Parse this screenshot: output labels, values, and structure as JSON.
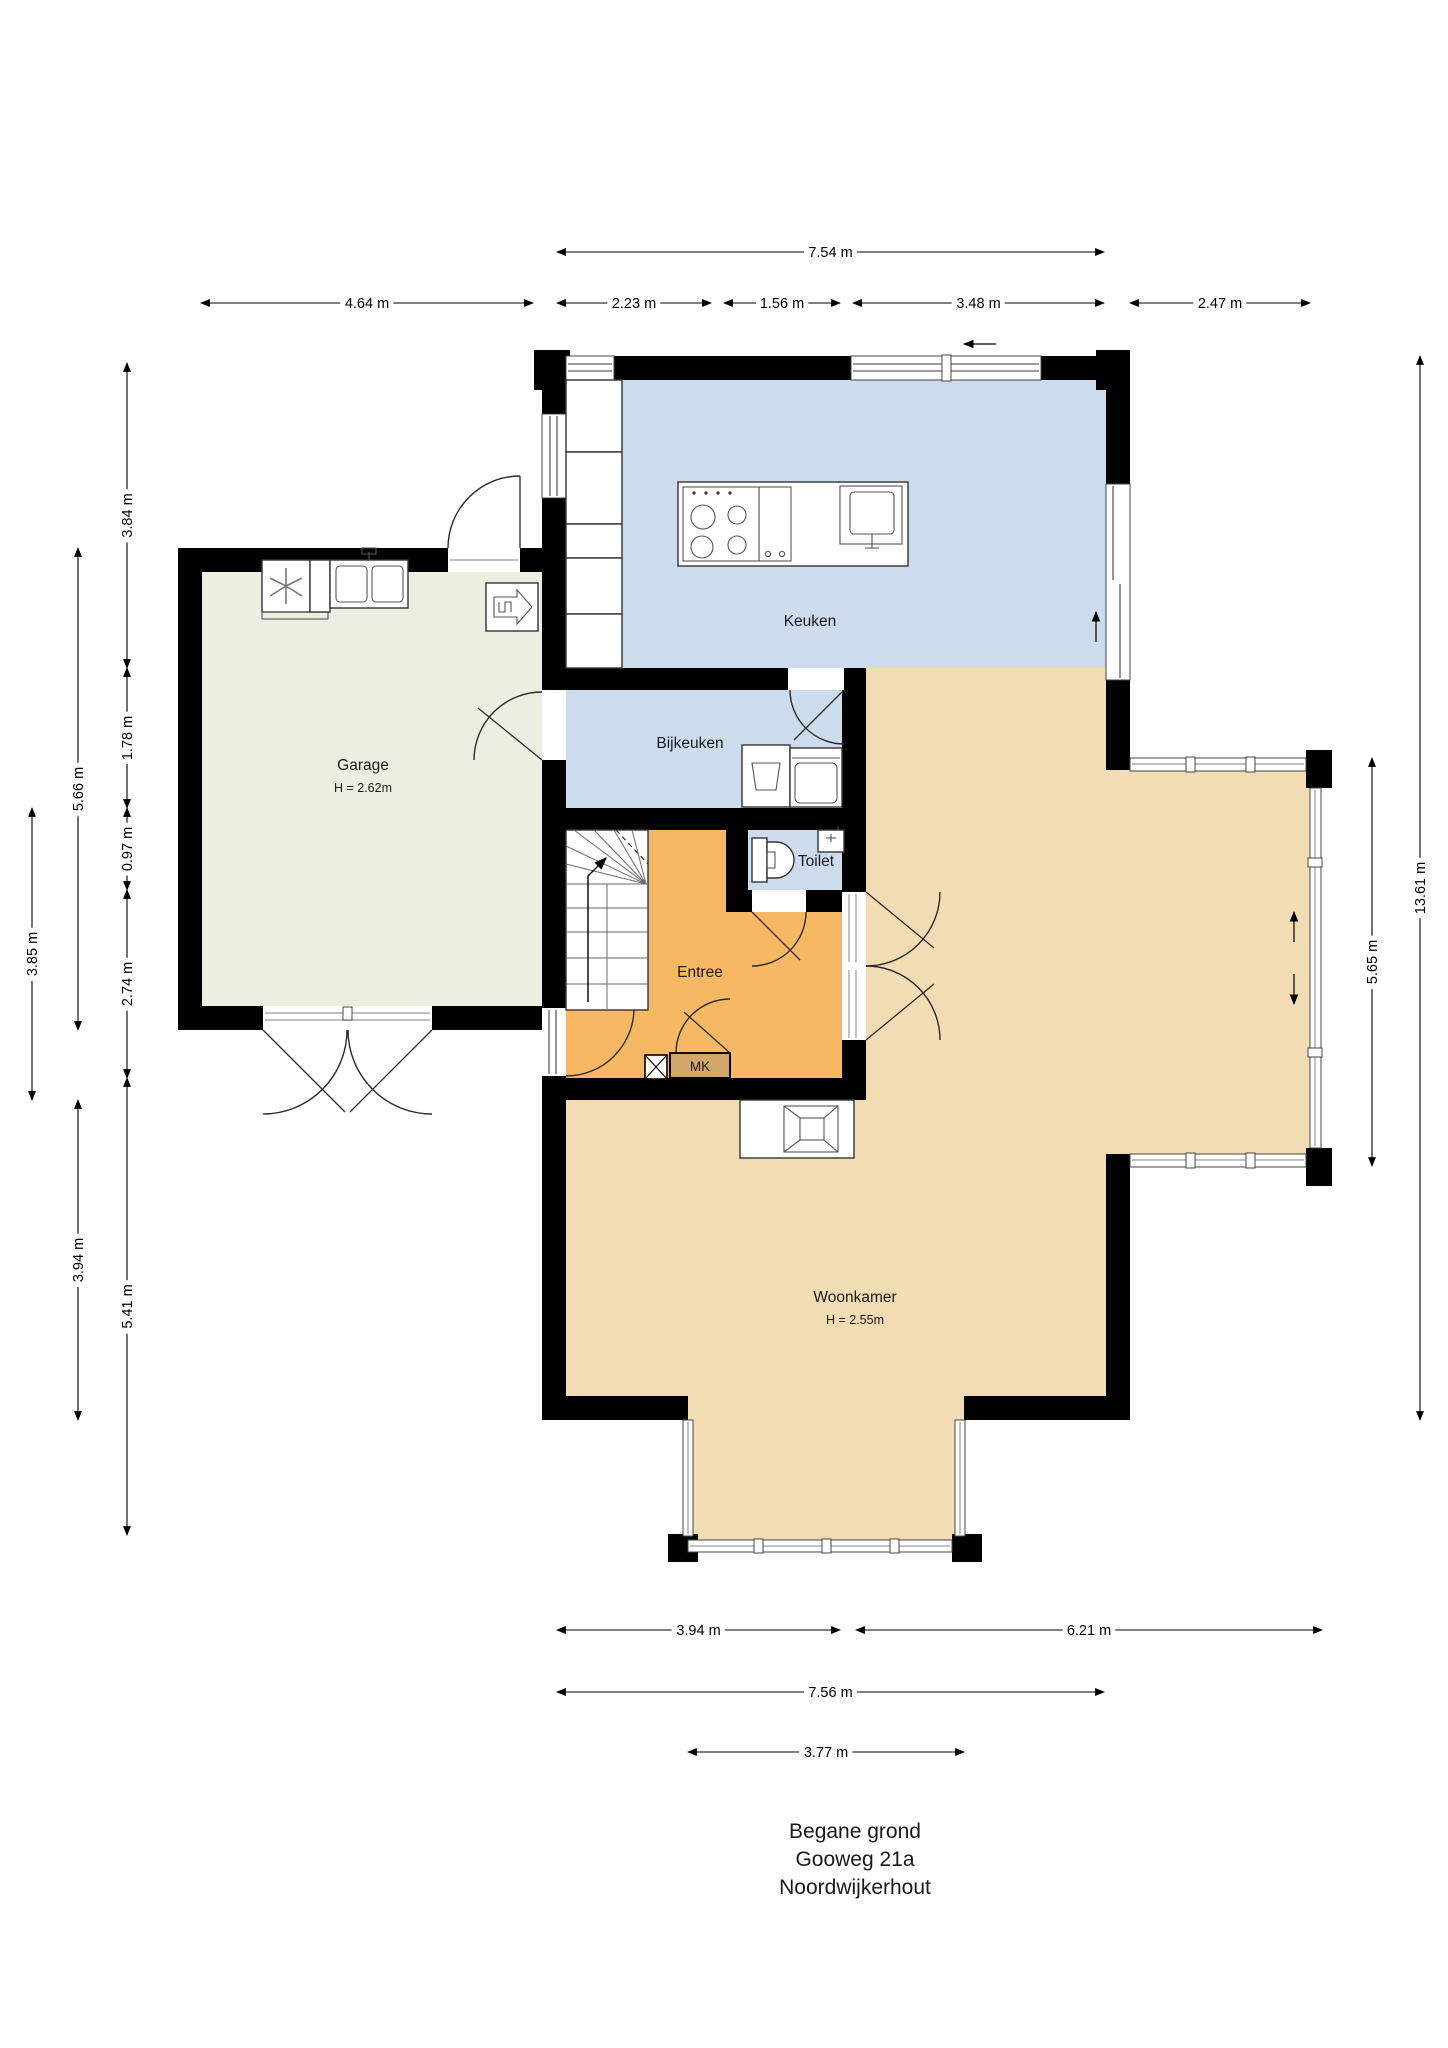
{
  "plan": {
    "title_lines": [
      "Begane grond",
      "Gooweg 21a",
      "Noordwijkerhout"
    ],
    "rooms": {
      "keuken": {
        "label": "Keuken"
      },
      "bijkeuken": {
        "label": "Bijkeuken"
      },
      "garage": {
        "label": "Garage",
        "ceiling": "H = 2.62m"
      },
      "toilet": {
        "label": "Toilet"
      },
      "entree": {
        "label": "Entree"
      },
      "meterkast": {
        "label": "MK"
      },
      "woonkamer": {
        "label": "Woonkamer",
        "ceiling": "H = 2.55m"
      }
    },
    "colors": {
      "kitchen_zone": "#cddcec",
      "utility_zone": "#cddcec",
      "toilet_zone": "#cddcec",
      "entree_zone": "#f6b862",
      "living_zone": "#f1dcb4",
      "garage_zone": "#eceee2",
      "meterkast_fill": "#d2a76b",
      "wall": "#000000"
    },
    "icons": [
      "staircase-up-arrow",
      "sliding-door-arrow-up",
      "sliding-door-arrow-down",
      "boiler-arrow",
      "washing-machine-fan",
      "double-sink",
      "fireplace-square",
      "stove-burners",
      "island-sink",
      "toilet-bowl",
      "vent-arrow-left",
      "meter-x-box"
    ]
  },
  "dimensions": [
    {
      "label": "7.54 m",
      "x1": 557,
      "y1": 252,
      "x2": 1104,
      "y2": 252
    },
    {
      "label": "4.64 m",
      "x1": 201,
      "y1": 303,
      "x2": 533,
      "y2": 303
    },
    {
      "label": "2.23 m",
      "x1": 557,
      "y1": 303,
      "x2": 711,
      "y2": 303
    },
    {
      "label": "1.56 m",
      "x1": 724,
      "y1": 303,
      "x2": 840,
      "y2": 303
    },
    {
      "label": "3.48 m",
      "x1": 853,
      "y1": 303,
      "x2": 1104,
      "y2": 303
    },
    {
      "label": "2.47 m",
      "x1": 1130,
      "y1": 303,
      "x2": 1310,
      "y2": 303
    },
    {
      "label": "3.84 m",
      "x1": 127,
      "y1": 363,
      "x2": 127,
      "y2": 668
    },
    {
      "label": "1.78 m",
      "x1": 127,
      "y1": 668,
      "x2": 127,
      "y2": 808
    },
    {
      "label": "0.97 m",
      "x1": 127,
      "y1": 808,
      "x2": 127,
      "y2": 890
    },
    {
      "label": "2.74 m",
      "x1": 127,
      "y1": 890,
      "x2": 127,
      "y2": 1078
    },
    {
      "label": "5.41 m",
      "x1": 127,
      "y1": 1078,
      "x2": 127,
      "y2": 1535
    },
    {
      "label": "5.66 m",
      "x1": 78,
      "y1": 548,
      "x2": 78,
      "y2": 1030
    },
    {
      "label": "3.94 m",
      "x1": 78,
      "y1": 1100,
      "x2": 78,
      "y2": 1420
    },
    {
      "label": "3.85 m",
      "x1": 32,
      "y1": 808,
      "x2": 32,
      "y2": 1100
    },
    {
      "label": "5.65 m",
      "x1": 1372,
      "y1": 758,
      "x2": 1372,
      "y2": 1166
    },
    {
      "label": "13.61 m",
      "x1": 1420,
      "y1": 356,
      "x2": 1420,
      "y2": 1420
    },
    {
      "label": "3.94 m",
      "x1": 557,
      "y1": 1630,
      "x2": 840,
      "y2": 1630
    },
    {
      "label": "6.21 m",
      "x1": 856,
      "y1": 1630,
      "x2": 1322,
      "y2": 1630
    },
    {
      "label": "7.56 m",
      "x1": 557,
      "y1": 1692,
      "x2": 1104,
      "y2": 1692
    },
    {
      "label": "3.77 m",
      "x1": 688,
      "y1": 1752,
      "x2": 964,
      "y2": 1752
    }
  ]
}
